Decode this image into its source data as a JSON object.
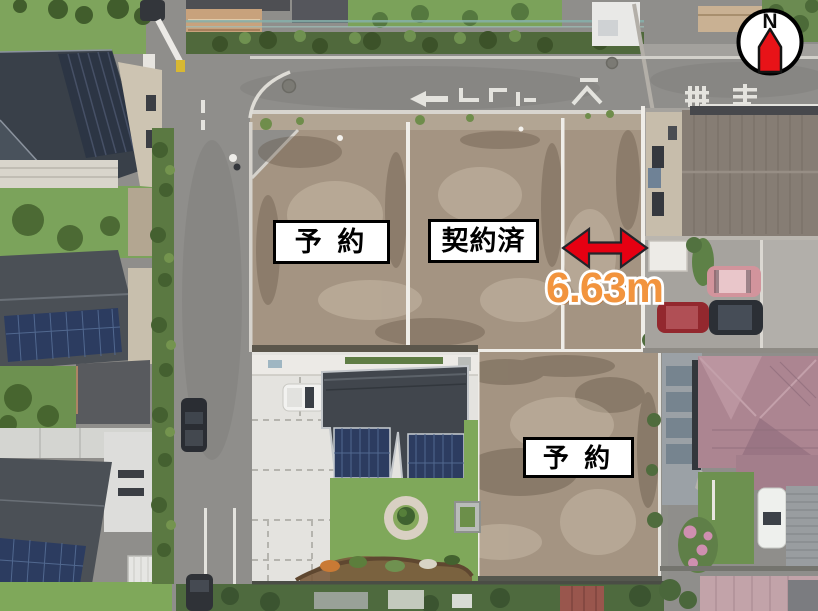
{
  "annotations": {
    "lot_status_labels": [
      {
        "text": "予 約"
      },
      {
        "text": "契約済"
      },
      {
        "text": "予 約"
      }
    ],
    "measurement": {
      "text": "6.63m",
      "fill": "#f2943e",
      "outline": "#ffffff",
      "shadow": "#bc6a22"
    },
    "dimension_arrow": {
      "fill": "#e60012",
      "stroke": "#23242a"
    },
    "compass": {
      "text": "N",
      "needle_fill": "#e81318",
      "ring_fill": "#ffffff",
      "ring_stroke": "#000000"
    }
  },
  "scene_colors": {
    "asphalt": "#8f8e8b",
    "dirt": "#a49482",
    "gravel": "#b2a593",
    "lawn": "#7fa85a",
    "garden": "#6d9150",
    "hedge": "#5b7942",
    "concrete": "#e4e3df",
    "charcoal_roof": "#41464d",
    "navy_roof": "#394049",
    "gray_roof": "#4b5056",
    "solar_panel": "#2c3c60",
    "beige_wall": "#cdc4b2",
    "brown_roof": "#867d74",
    "pink_roof": "#ac8591",
    "white_line": "#efede8"
  }
}
